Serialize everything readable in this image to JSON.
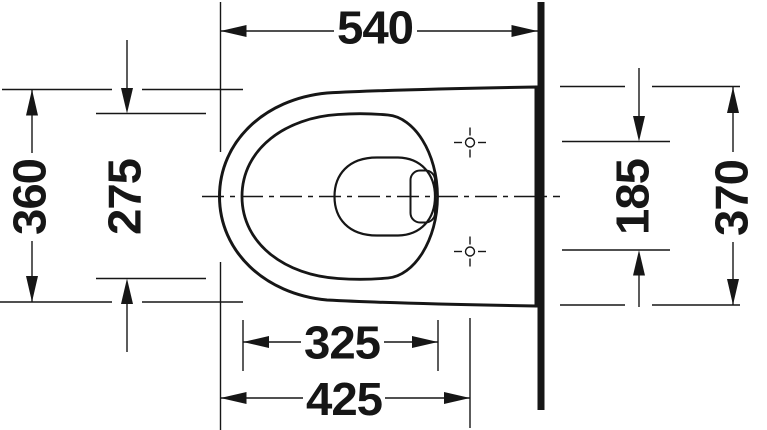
{
  "drawing": {
    "dimensions": {
      "top_depth": "540",
      "left_outer_width": "360",
      "left_inner_width": "275",
      "right_hole_spacing": "185",
      "right_outer_width": "370",
      "bottom_inner_length": "325",
      "bottom_outer_length": "425"
    },
    "colors": {
      "line": "#161616",
      "background": "#ffffff"
    }
  }
}
